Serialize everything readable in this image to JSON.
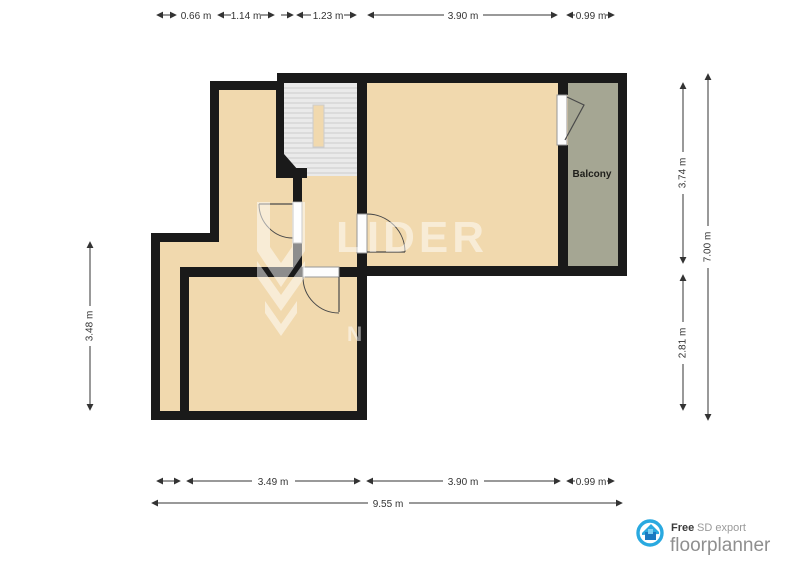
{
  "title": "Floor plan export",
  "rooms": {
    "balcony_label": "Balcony"
  },
  "dimensions": {
    "top": [
      {
        "label": "0.66 m"
      },
      {
        "label": "1.14 m"
      },
      {
        "label": "1.23 m"
      },
      {
        "label": "3.90 m"
      },
      {
        "label": "0.99 m"
      }
    ],
    "bottom_inner": [
      {
        "label": "3.49 m"
      },
      {
        "label": "3.90 m"
      },
      {
        "label": "0.99 m"
      }
    ],
    "bottom_outer": {
      "label": "9.55 m"
    },
    "left": {
      "label": "3.48 m"
    },
    "right_inner": [
      {
        "label": "3.74 m"
      },
      {
        "label": "2.81 m"
      }
    ],
    "right_outer": {
      "label": "7.00 m"
    }
  },
  "watermark": {
    "brand": "LIDER",
    "letter": "N"
  },
  "footer": {
    "free": "Free",
    "sd_export": "SD export",
    "brand": "floorplanner"
  },
  "colors": {
    "wall": "#1a1a1a",
    "floor": "#f1d9ae",
    "balcony": "#a5a693",
    "stairs": "#eaeaea",
    "tread": "#cccccc",
    "dim": "#333333",
    "accent_blue": "#29a9e0",
    "logo_text": "#8f8f8f"
  }
}
